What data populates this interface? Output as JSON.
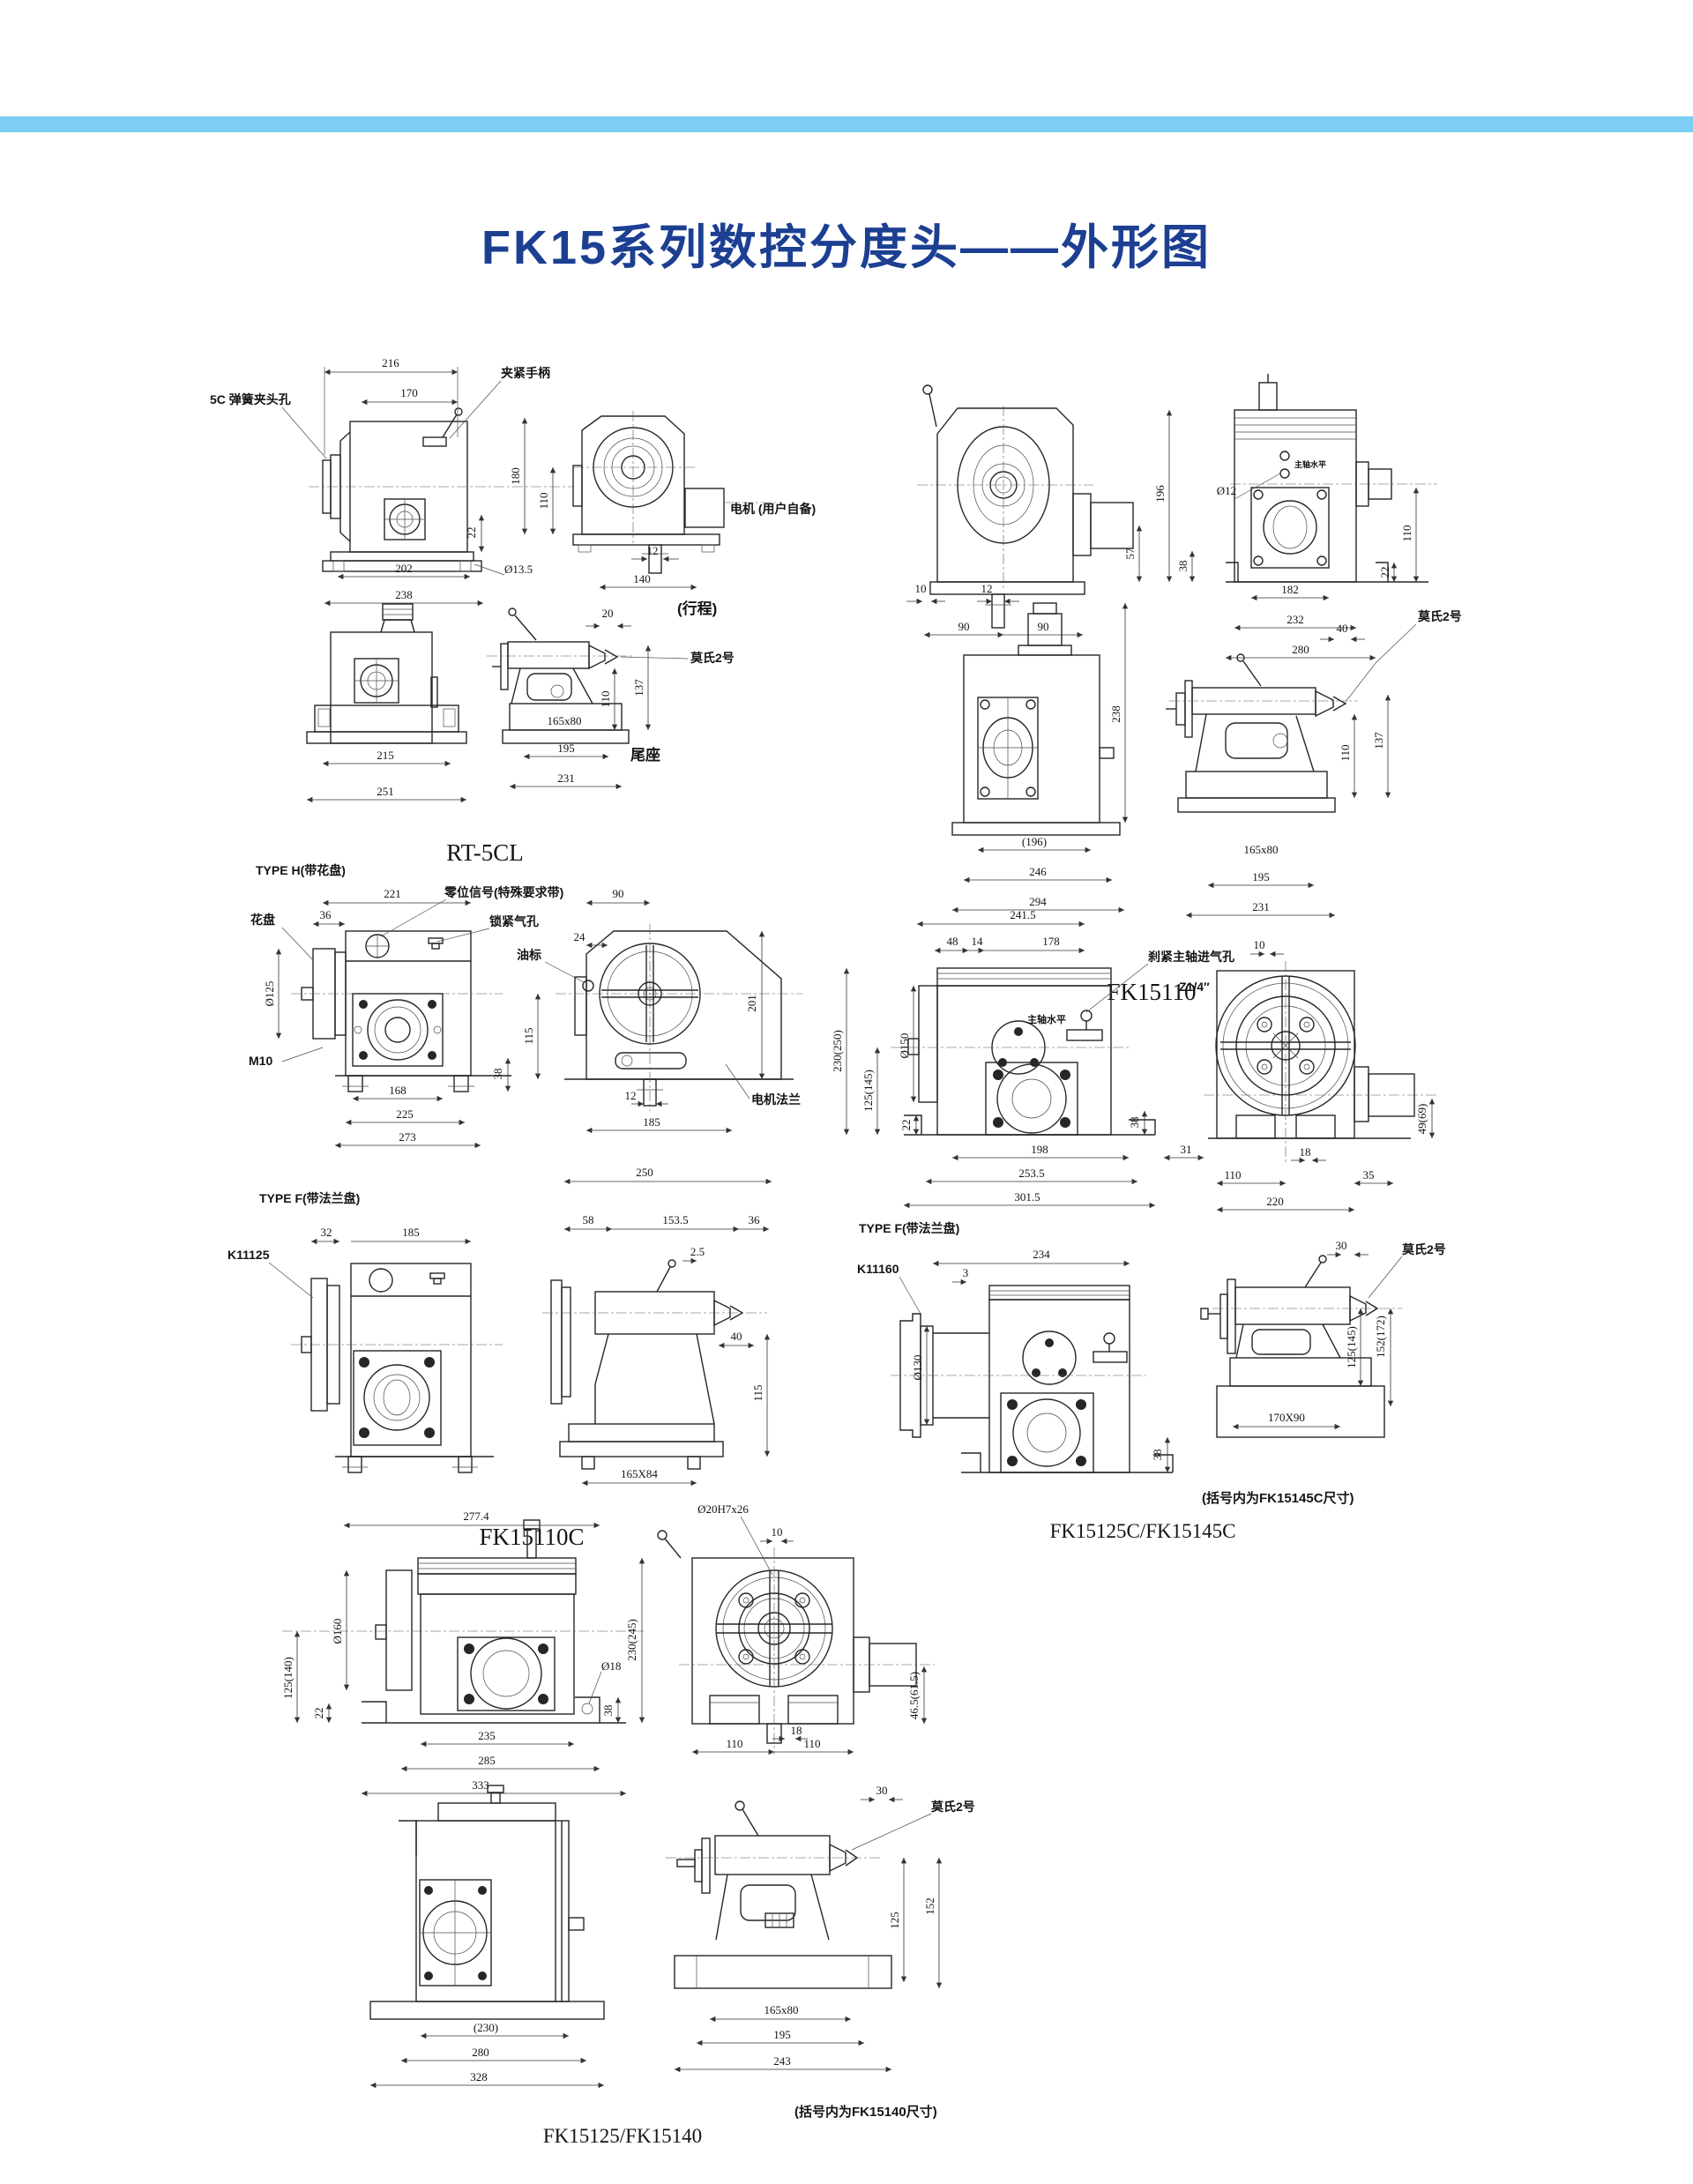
{
  "page": {
    "title": "FK15系列数控分度头——外形图",
    "title_color": "#1c3f92",
    "band_color": "#7ecdf2"
  },
  "rt5cl": {
    "caption": "RT-5CL",
    "lbl_collet": "5C 弹簧夹头孔",
    "lbl_handle": "夹紧手柄",
    "lbl_motor": "电机 (用户自备)",
    "lbl_travel": "(行程)",
    "lbl_morse": "莫氏2号",
    "lbl_tailstock": "尾座",
    "d216": "216",
    "d170": "170",
    "d180": "180",
    "d110side": "110",
    "d22": "22",
    "d202": "202",
    "d13_5": "Ø13.5",
    "d238": "238",
    "d12": "12",
    "d140": "140",
    "d20": "20",
    "d215": "215",
    "d251": "251",
    "d110tail": "110",
    "d137": "137",
    "d165x80": "165x80",
    "d195": "195",
    "d231": "231"
  },
  "fk15110": {
    "caption": "FK15110",
    "lbl_level": "主轴水平",
    "lbl_morse": "莫氏2号",
    "d10": "10",
    "d12": "12",
    "d90a": "90",
    "d90b": "90",
    "d57": "57",
    "d196": "196",
    "dphi12": "Ø12",
    "d38": "38",
    "d110": "110",
    "d22": "22",
    "d182": "182",
    "d232": "232",
    "d280": "280",
    "d238": "238",
    "d196p": "(196)",
    "d246": "246",
    "d294": "294",
    "d40": "40",
    "d110t": "110",
    "d137": "137",
    "d165x80": "165x80",
    "d195": "195",
    "d231": "231"
  },
  "fk15110c": {
    "caption": "FK15110C",
    "type_h": "TYPE H(带花盘)",
    "type_f": "TYPE F(带法兰盘)",
    "lbl_faceplate": "花盘",
    "lbl_zero": "零位信号(特殊要求带)",
    "lbl_lock": "锁紧气孔",
    "lbl_oil": "油标",
    "lbl_flange": "电机法兰",
    "lbl_k11125": "K11125",
    "d221": "221",
    "d36": "36",
    "dphi125": "Ø125",
    "dm10": "M10",
    "d38": "38",
    "d168": "168",
    "d225": "225",
    "d273": "273",
    "d90": "90",
    "d24": "24",
    "d115": "115",
    "d201": "201",
    "d12": "12",
    "d185": "185",
    "d32": "32",
    "d185f": "185",
    "d250": "250",
    "d58": "58",
    "d153_5": "153.5",
    "d36f": "36",
    "d2_5": "2.5",
    "d40": "40",
    "d115f": "115",
    "d165x84": "165X84"
  },
  "fk15125c": {
    "caption": "FK15125C/FK15145C",
    "type_f": "TYPE F(带法兰盘)",
    "note": "(括号内为FK15145C尺寸)",
    "lbl_brake": "刹紧主轴进气孔",
    "lbl_z14": "Z1/4″",
    "lbl_level": "主轴水平",
    "lbl_k11160": "K11160",
    "lbl_morse": "莫氏2号",
    "d241_5": "241.5",
    "d48": "48",
    "d14": "14",
    "d178": "178",
    "d10": "10",
    "d230_250": "230(250)",
    "d125_145": "125(145)",
    "dphi150": "Ø150",
    "d22": "22",
    "d38": "38",
    "d198": "198",
    "d253_5": "253.5",
    "d301_5": "301.5",
    "d31": "31",
    "d110": "110",
    "d18": "18",
    "d220": "220",
    "d35": "35",
    "d49_69": "49(69)",
    "d234": "234",
    "d3": "3",
    "dphi130": "Ø130",
    "d38f": "38",
    "d30": "30",
    "d125_145t": "125(145)",
    "d152_172": "152(172)",
    "d170x90": "170X90"
  },
  "fk15125": {
    "caption": "FK15125/FK15140",
    "note": "(括号内为FK15140尺寸)",
    "lbl_morse": "莫氏2号",
    "lbl_bore": "Ø20H7x26",
    "d277_4": "277.4",
    "dphi160": "Ø160",
    "d125_140": "125(140)",
    "d22": "22",
    "d235": "235",
    "d285": "285",
    "d333": "333",
    "dphi18": "Ø18",
    "d38": "38",
    "d230_245": "230(245)",
    "d10": "10",
    "d110a": "110",
    "d110b": "110",
    "d18": "18",
    "d46_5": "46.5(61.5)",
    "d30": "30",
    "d230p": "(230)",
    "d280": "280",
    "d328": "328",
    "d125": "125",
    "d152": "152",
    "d165x80": "165x80",
    "d195": "195",
    "d243": "243"
  }
}
